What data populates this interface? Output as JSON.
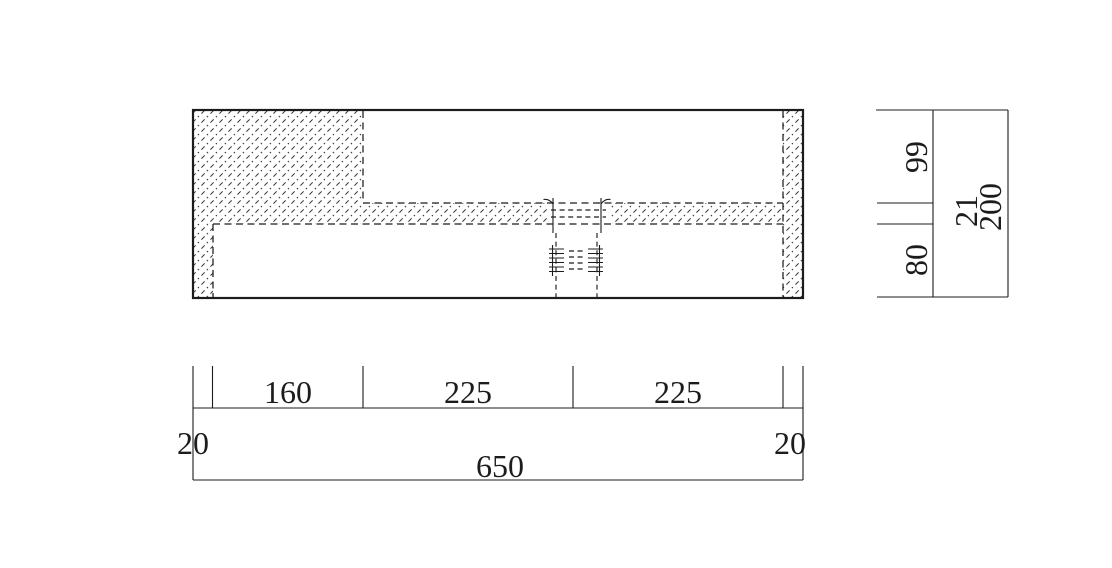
{
  "dimensions": {
    "horizontal": {
      "left_wall": "20",
      "block_width": "160",
      "left_bay": "225",
      "right_bay": "225",
      "right_wall": "20",
      "overall": "650"
    },
    "vertical": {
      "upper_depth": "99",
      "slab_thickness": "21",
      "lower_depth": "80",
      "overall": "200"
    }
  },
  "colors": {
    "line_color": "#1c1c1c",
    "hatch_color": "#3a3a3a",
    "background": "#ffffff"
  }
}
